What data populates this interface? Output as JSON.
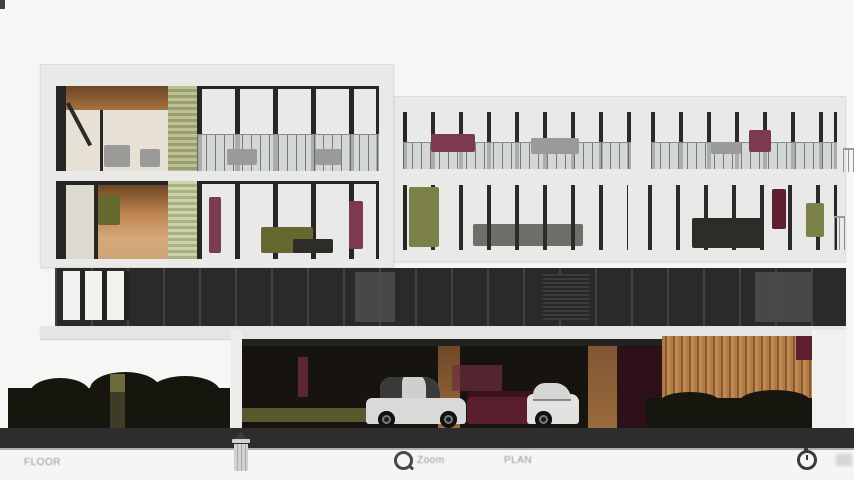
{
  "meta": {
    "view": "apartment-building-front-elevation-render"
  },
  "toolbar": {
    "left_label": "FLOOR",
    "zoom_label": "Zoom",
    "center_label": "PLAN"
  },
  "icons": {
    "trash": "trash-icon",
    "zoom": "zoom-ring-icon",
    "clock": "clock-icon",
    "faint": "faint-element"
  },
  "colors": {
    "background": "#f6f6f5",
    "building_frame": "#e9e9e7",
    "podium_glass": "#2a2a28",
    "interior_warm": "#c08a5c",
    "louver_olive": "#a8ad7e",
    "wood_screen": "#b07c46",
    "accent_maroon": "#5e2030",
    "ground_band": "#2d2d2d",
    "toolbar_text": "#969696"
  }
}
